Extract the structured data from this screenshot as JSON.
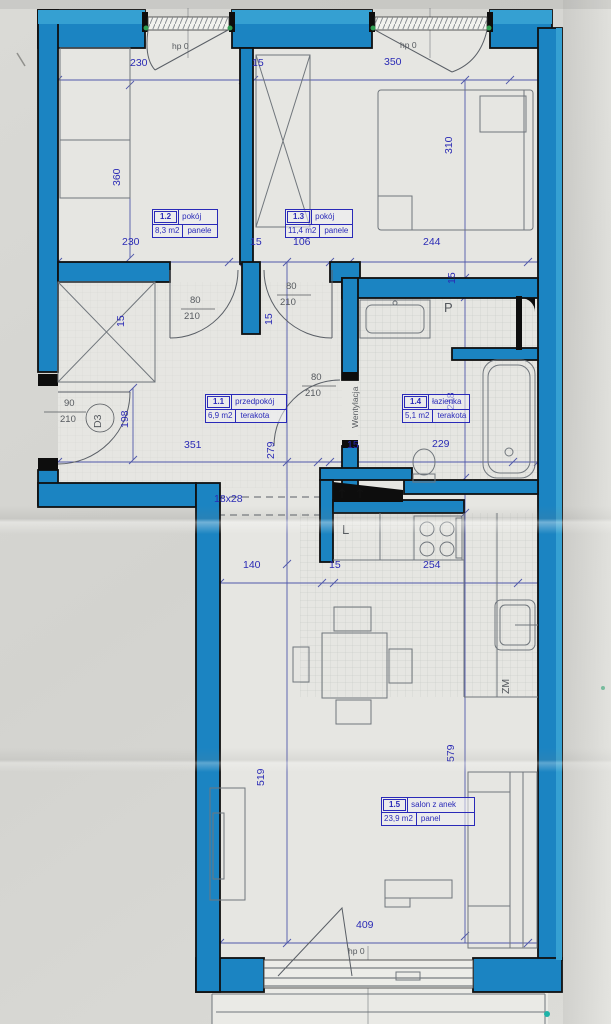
{
  "plan": {
    "drawing_type": "apartment floor plan",
    "colors": {
      "wall_blue": "#1b84c2",
      "dimension_text": "#2b2bb5",
      "annotation_gray": "#55595e",
      "label_blue": "#2a2ab8",
      "paper": "#d7d7d3",
      "green_marker": "#2f9e52"
    },
    "rooms": [
      {
        "num": "1.1",
        "name": "przedpokój",
        "area": "6,9 m2",
        "floor": "terakota"
      },
      {
        "num": "1.2",
        "name": "pokój",
        "area": "8,3 m2",
        "floor": "panele"
      },
      {
        "num": "1.3",
        "name": "pokój",
        "area": "11,4 m2",
        "floor": "panele"
      },
      {
        "num": "1.4",
        "name": "łazienka",
        "area": "5,1 m2",
        "floor": "terakota"
      },
      {
        "num": "1.5",
        "name": "salon z anek",
        "area": "23,9 m2",
        "floor": "panel"
      }
    ],
    "dims": [
      {
        "t": "230",
        "x": 130,
        "y": 58
      },
      {
        "t": "15",
        "x": 252,
        "y": 58
      },
      {
        "t": "350",
        "x": 384,
        "y": 57
      },
      {
        "t": "hp 0",
        "x": 172,
        "y": 42,
        "c": "g",
        "s": "sm",
        "n": "window-sill-height-label"
      },
      {
        "t": "hp 0",
        "x": 400,
        "y": 41,
        "c": "g",
        "s": "sm",
        "n": "window-sill-height-label"
      },
      {
        "t": "360",
        "x": 112,
        "y": 186,
        "r": 1
      },
      {
        "t": "310",
        "x": 444,
        "y": 154,
        "r": 1
      },
      {
        "t": "230",
        "x": 122,
        "y": 237
      },
      {
        "t": "15",
        "x": 250,
        "y": 237
      },
      {
        "t": "106",
        "x": 293,
        "y": 237
      },
      {
        "t": "244",
        "x": 423,
        "y": 237
      },
      {
        "t": "15",
        "x": 447,
        "y": 284,
        "r": 1
      },
      {
        "t": "15",
        "x": 116,
        "y": 327,
        "r": 1
      },
      {
        "t": "15",
        "x": 264,
        "y": 325,
        "r": 1
      },
      {
        "t": "80",
        "x": 190,
        "y": 296,
        "c": "g",
        "s": "md",
        "n": "door-width-label"
      },
      {
        "t": "210",
        "x": 184,
        "y": 312,
        "c": "g",
        "s": "md",
        "n": "door-height-label"
      },
      {
        "t": "80",
        "x": 286,
        "y": 282,
        "c": "g",
        "s": "md",
        "n": "door-width-label"
      },
      {
        "t": "210",
        "x": 280,
        "y": 298,
        "c": "g",
        "s": "md",
        "n": "door-height-label"
      },
      {
        "t": "80",
        "x": 311,
        "y": 373,
        "c": "g",
        "s": "md",
        "n": "door-width-label"
      },
      {
        "t": "210",
        "x": 305,
        "y": 389,
        "c": "g",
        "s": "md",
        "n": "door-height-label"
      },
      {
        "t": "90",
        "x": 64,
        "y": 399,
        "c": "g",
        "s": "md",
        "n": "entry-door-width-label"
      },
      {
        "t": "210",
        "x": 60,
        "y": 415,
        "c": "g",
        "s": "md",
        "n": "entry-door-height-label"
      },
      {
        "t": "D3",
        "x": 93,
        "y": 428,
        "r": 1,
        "c": "g",
        "n": "door-symbol-label"
      },
      {
        "t": "198",
        "x": 120,
        "y": 428,
        "r": 1
      },
      {
        "t": "Wentylacja",
        "x": 351,
        "y": 428,
        "r": 1,
        "c": "g",
        "s": "sm",
        "n": "ventilation-label"
      },
      {
        "t": "248",
        "x": 446,
        "y": 410,
        "r": 1
      },
      {
        "t": "351",
        "x": 184,
        "y": 440
      },
      {
        "t": "279",
        "x": 266,
        "y": 459,
        "r": 1
      },
      {
        "t": "15",
        "x": 347,
        "y": 440
      },
      {
        "t": "229",
        "x": 432,
        "y": 439
      },
      {
        "t": "18x28",
        "x": 214,
        "y": 494,
        "n": "step-dimension-label"
      },
      {
        "t": "140",
        "x": 243,
        "y": 560
      },
      {
        "t": "15",
        "x": 329,
        "y": 560
      },
      {
        "t": "254",
        "x": 423,
        "y": 560
      },
      {
        "t": "519",
        "x": 256,
        "y": 786,
        "r": 1
      },
      {
        "t": "579",
        "x": 446,
        "y": 762,
        "r": 1
      },
      {
        "t": "409",
        "x": 356,
        "y": 920
      },
      {
        "t": "hp 0",
        "x": 348,
        "y": 947,
        "c": "g",
        "s": "sm",
        "n": "window-sill-height-label"
      },
      {
        "t": "P",
        "x": 444,
        "y": 301,
        "c": "g",
        "s": "lg",
        "n": "washing-machine-label"
      },
      {
        "t": "L",
        "x": 342,
        "y": 523,
        "c": "g",
        "s": "lg",
        "n": "fridge-label"
      },
      {
        "t": "ZM",
        "x": 501,
        "y": 694,
        "r": 1,
        "c": "g",
        "n": "sink-label"
      }
    ]
  }
}
